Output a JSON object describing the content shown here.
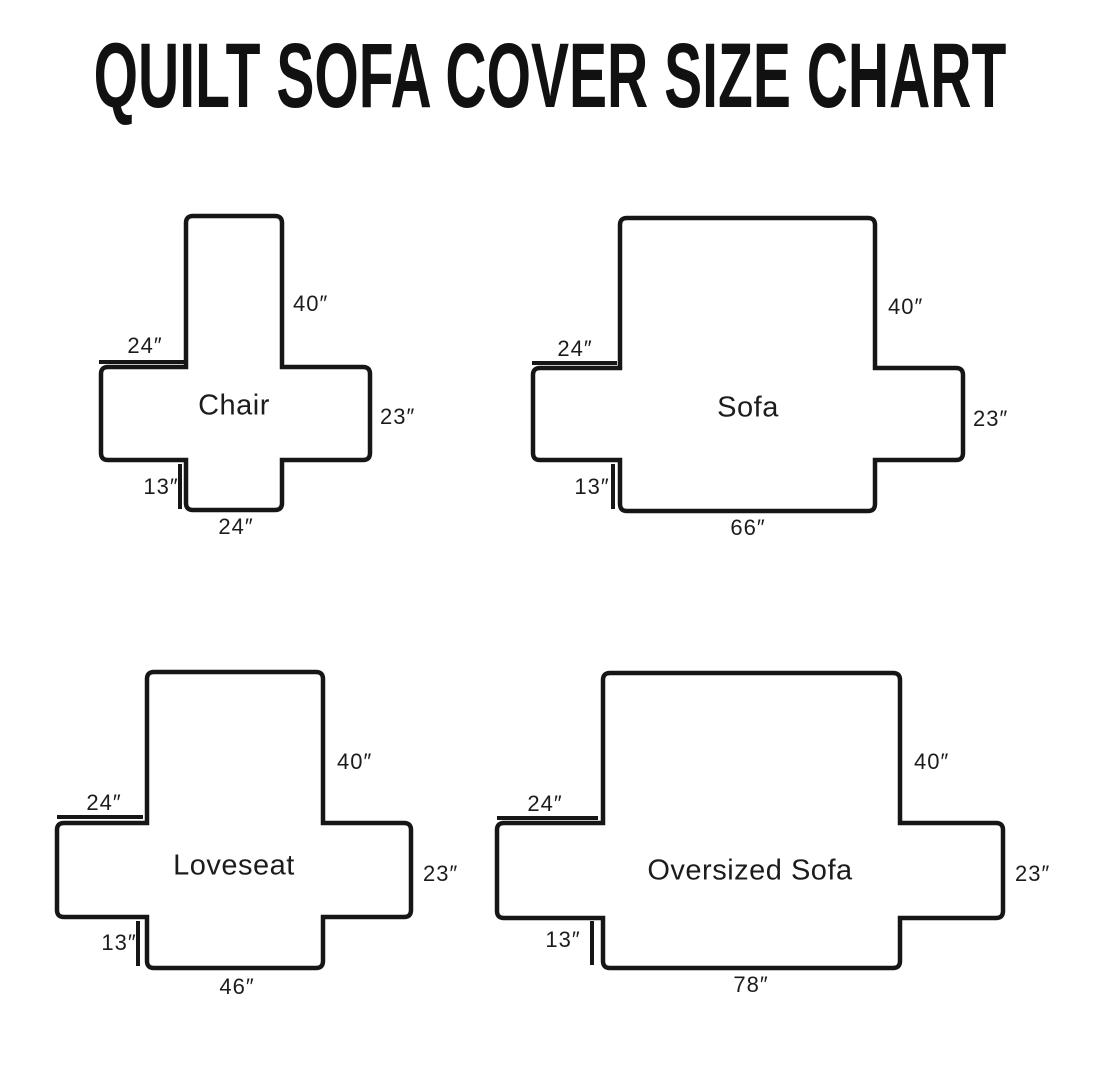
{
  "title": "QUILT SOFA COVER SIZE CHART",
  "diagrams": [
    {
      "name": "Chair",
      "back_height": "40″",
      "arm_top_width": "24″",
      "arm_side_depth": "23″",
      "front_skirt_height": "13″",
      "bottom_width": "24″"
    },
    {
      "name": "Sofa",
      "back_height": "40″",
      "arm_top_width": "24″",
      "arm_side_depth": "23″",
      "front_skirt_height": "13″",
      "bottom_width": "66″"
    },
    {
      "name": "Loveseat",
      "back_height": "40″",
      "arm_top_width": "24″",
      "arm_side_depth": "23″",
      "front_skirt_height": "13″",
      "bottom_width": "46″"
    },
    {
      "name": "Oversized Sofa",
      "back_height": "40″",
      "arm_top_width": "24″",
      "arm_side_depth": "23″",
      "front_skirt_height": "13″",
      "bottom_width": "78″"
    }
  ],
  "ink_color": "#161616",
  "background_color": "#ffffff"
}
